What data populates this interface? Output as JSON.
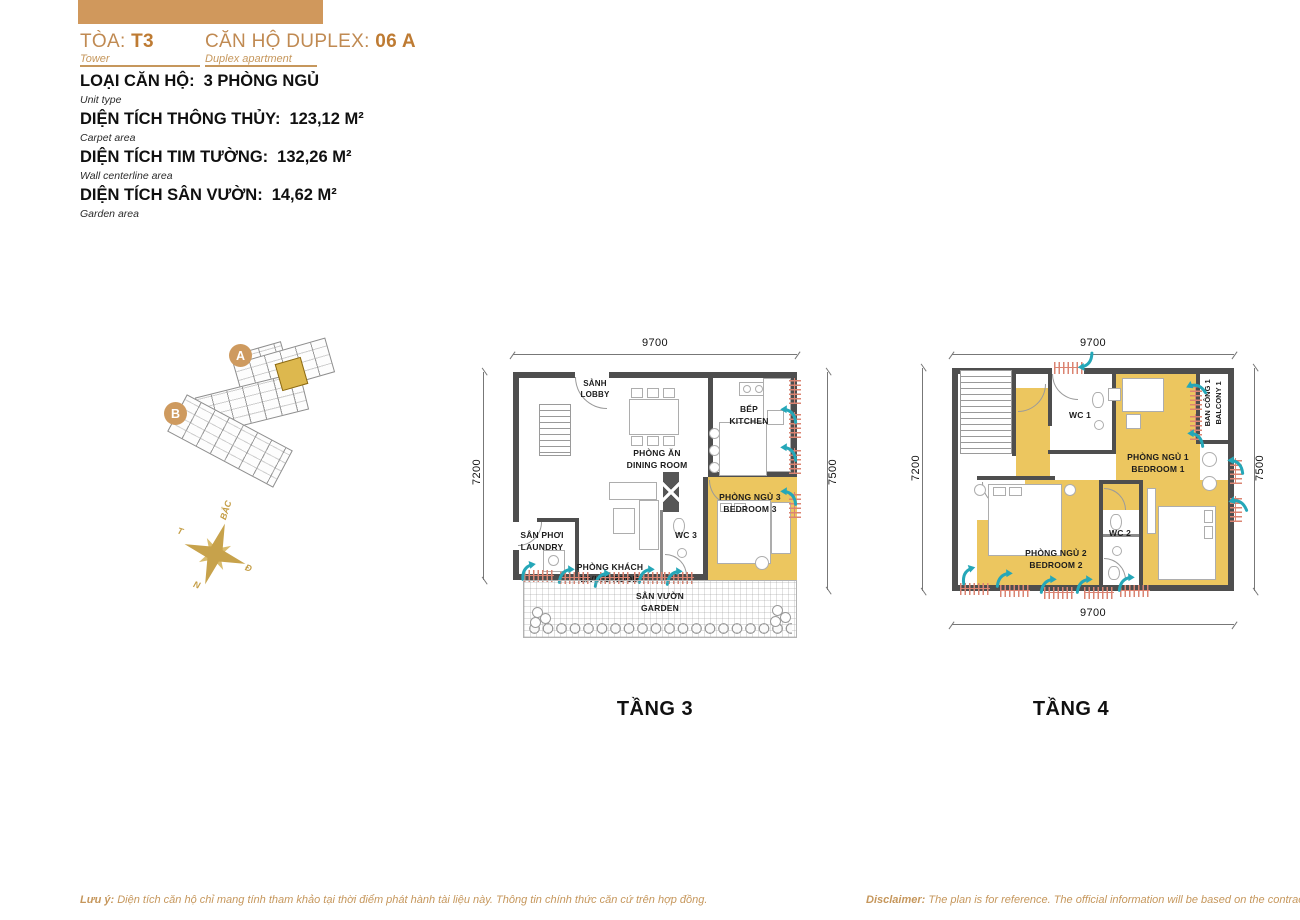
{
  "header": {
    "tower_label": "TÒA:",
    "tower_value": "T3",
    "tower_sublabel": "Tower",
    "unit_label": "CĂN HỘ DUPLEX:",
    "unit_value": "06 A",
    "unit_sublabel": "Duplex apartment"
  },
  "specs": [
    {
      "label": "LOẠI CĂN HỘ:",
      "value": "3 PHÒNG NGỦ",
      "sublabel": "Unit type"
    },
    {
      "label": "DIỆN TÍCH THÔNG THỦY:",
      "value": "123,12 M²",
      "sublabel": "Carpet area"
    },
    {
      "label": "DIỆN TÍCH TIM TƯỜNG:",
      "value": "132,26 M²",
      "sublabel": "Wall centerline area"
    },
    {
      "label": "DIỆN TÍCH SÂN VƯỜN:",
      "value": "14,62 M²",
      "sublabel": "Garden area"
    }
  ],
  "overview": {
    "marker_a": "A",
    "marker_b": "B"
  },
  "compass": {
    "north": "BẮC",
    "east": "Đ",
    "south": "N",
    "west": "T"
  },
  "floor3": {
    "title": "TẦNG 3",
    "dims": {
      "top": "9700",
      "left": "7200",
      "right": "7500"
    },
    "rooms": {
      "lobby": {
        "vn": "SẢNH",
        "en": "LOBBY"
      },
      "dining": {
        "vn": "PHÒNG ĂN",
        "en": "DINING ROOM"
      },
      "kitchen": {
        "vn": "BẾP",
        "en": "KITCHEN"
      },
      "bedroom3": {
        "vn": "PHÒNG NGỦ 3",
        "en": "BEDROOM 3"
      },
      "wc3": {
        "vn": "WC 3"
      },
      "living": {
        "vn": "PHÒNG KHÁCH",
        "en": "LIVING ROOM"
      },
      "laundry": {
        "vn": "SÂN PHƠI",
        "en": "LAUNDRY"
      },
      "garden": {
        "vn": "SÂN VƯỜN",
        "en": "GARDEN"
      }
    }
  },
  "floor4": {
    "title": "TẦNG 4",
    "dims": {
      "top": "9700",
      "left": "7200",
      "right": "7500",
      "bottom": "9700"
    },
    "rooms": {
      "wc1": {
        "vn": "WC 1"
      },
      "bedroom1": {
        "vn": "PHÒNG NGỦ 1",
        "en": "BEDROOM 1"
      },
      "balcony1": {
        "vn": "BAN CÔNG 1",
        "en": "BALCONY 1"
      },
      "bedroom2": {
        "vn": "PHÒNG NGỦ 2",
        "en": "BEDROOM 2"
      },
      "wc2": {
        "vn": "WC 2"
      }
    }
  },
  "footer": {
    "note_label": "Lưu ý:",
    "note_text": "Diện tích căn hộ chỉ mang tính tham khảo tại thời điểm phát hành tài liệu này. Thông tin chính thức căn cứ trên hợp đồng.",
    "disclaimer_label": "Disclaimer:",
    "disclaimer_text": "The plan is for reference. The official information will be based on the contract"
  },
  "colors": {
    "accent_gold": "#ECC65F",
    "wall_gray": "#4E4E4E",
    "vent_teal": "#25A7B8",
    "brand_tan": "#C6975C",
    "brand_orange": "#BE7B33",
    "window_red": "#DB8472"
  },
  "icons": {
    "vent_arrow": "curved-teal-airflow-arrow",
    "compass_rose": "gold-eight-point-star",
    "key_plan": "building-footprint-mini-map"
  }
}
